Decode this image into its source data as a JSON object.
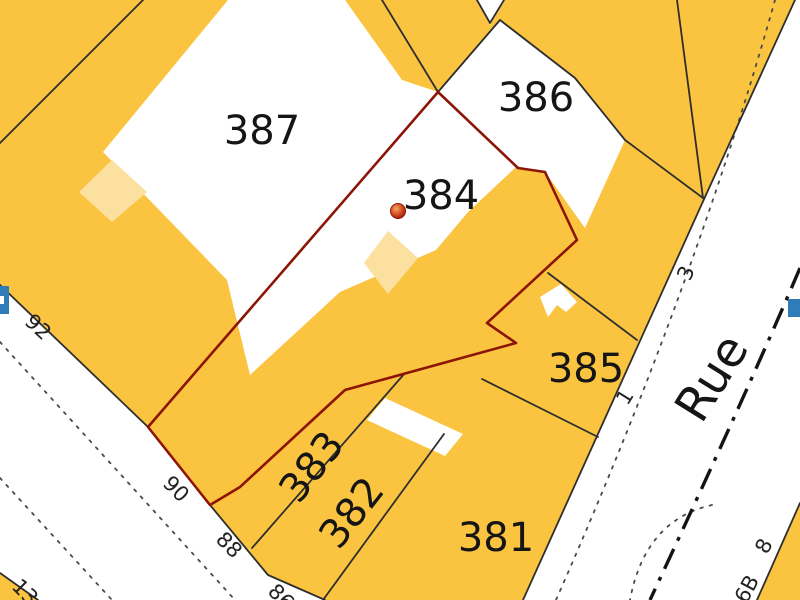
{
  "map": {
    "type": "cadastral-map",
    "selected_parcel": "384",
    "parcels": [
      {
        "number": "387"
      },
      {
        "number": "386"
      },
      {
        "number": "384"
      },
      {
        "number": "385"
      },
      {
        "number": "383"
      },
      {
        "number": "382"
      },
      {
        "number": "381"
      }
    ],
    "house_numbers": [
      "92",
      "90",
      "88",
      "86",
      "13",
      "1",
      "3",
      "8",
      "6B"
    ],
    "street": {
      "name": "Rue"
    },
    "marker": {
      "type": "parcel-point-marker"
    },
    "colors": {
      "parcel_yellow": "#fbc440",
      "light_building": "#fce09f",
      "road_white": "#ffffff",
      "boundary_black": "#2e2e2e",
      "selected_boundary_red": "#8c1507",
      "marker_orange": "#d2491e",
      "hydrant_blue": "#2f7cb8"
    }
  }
}
